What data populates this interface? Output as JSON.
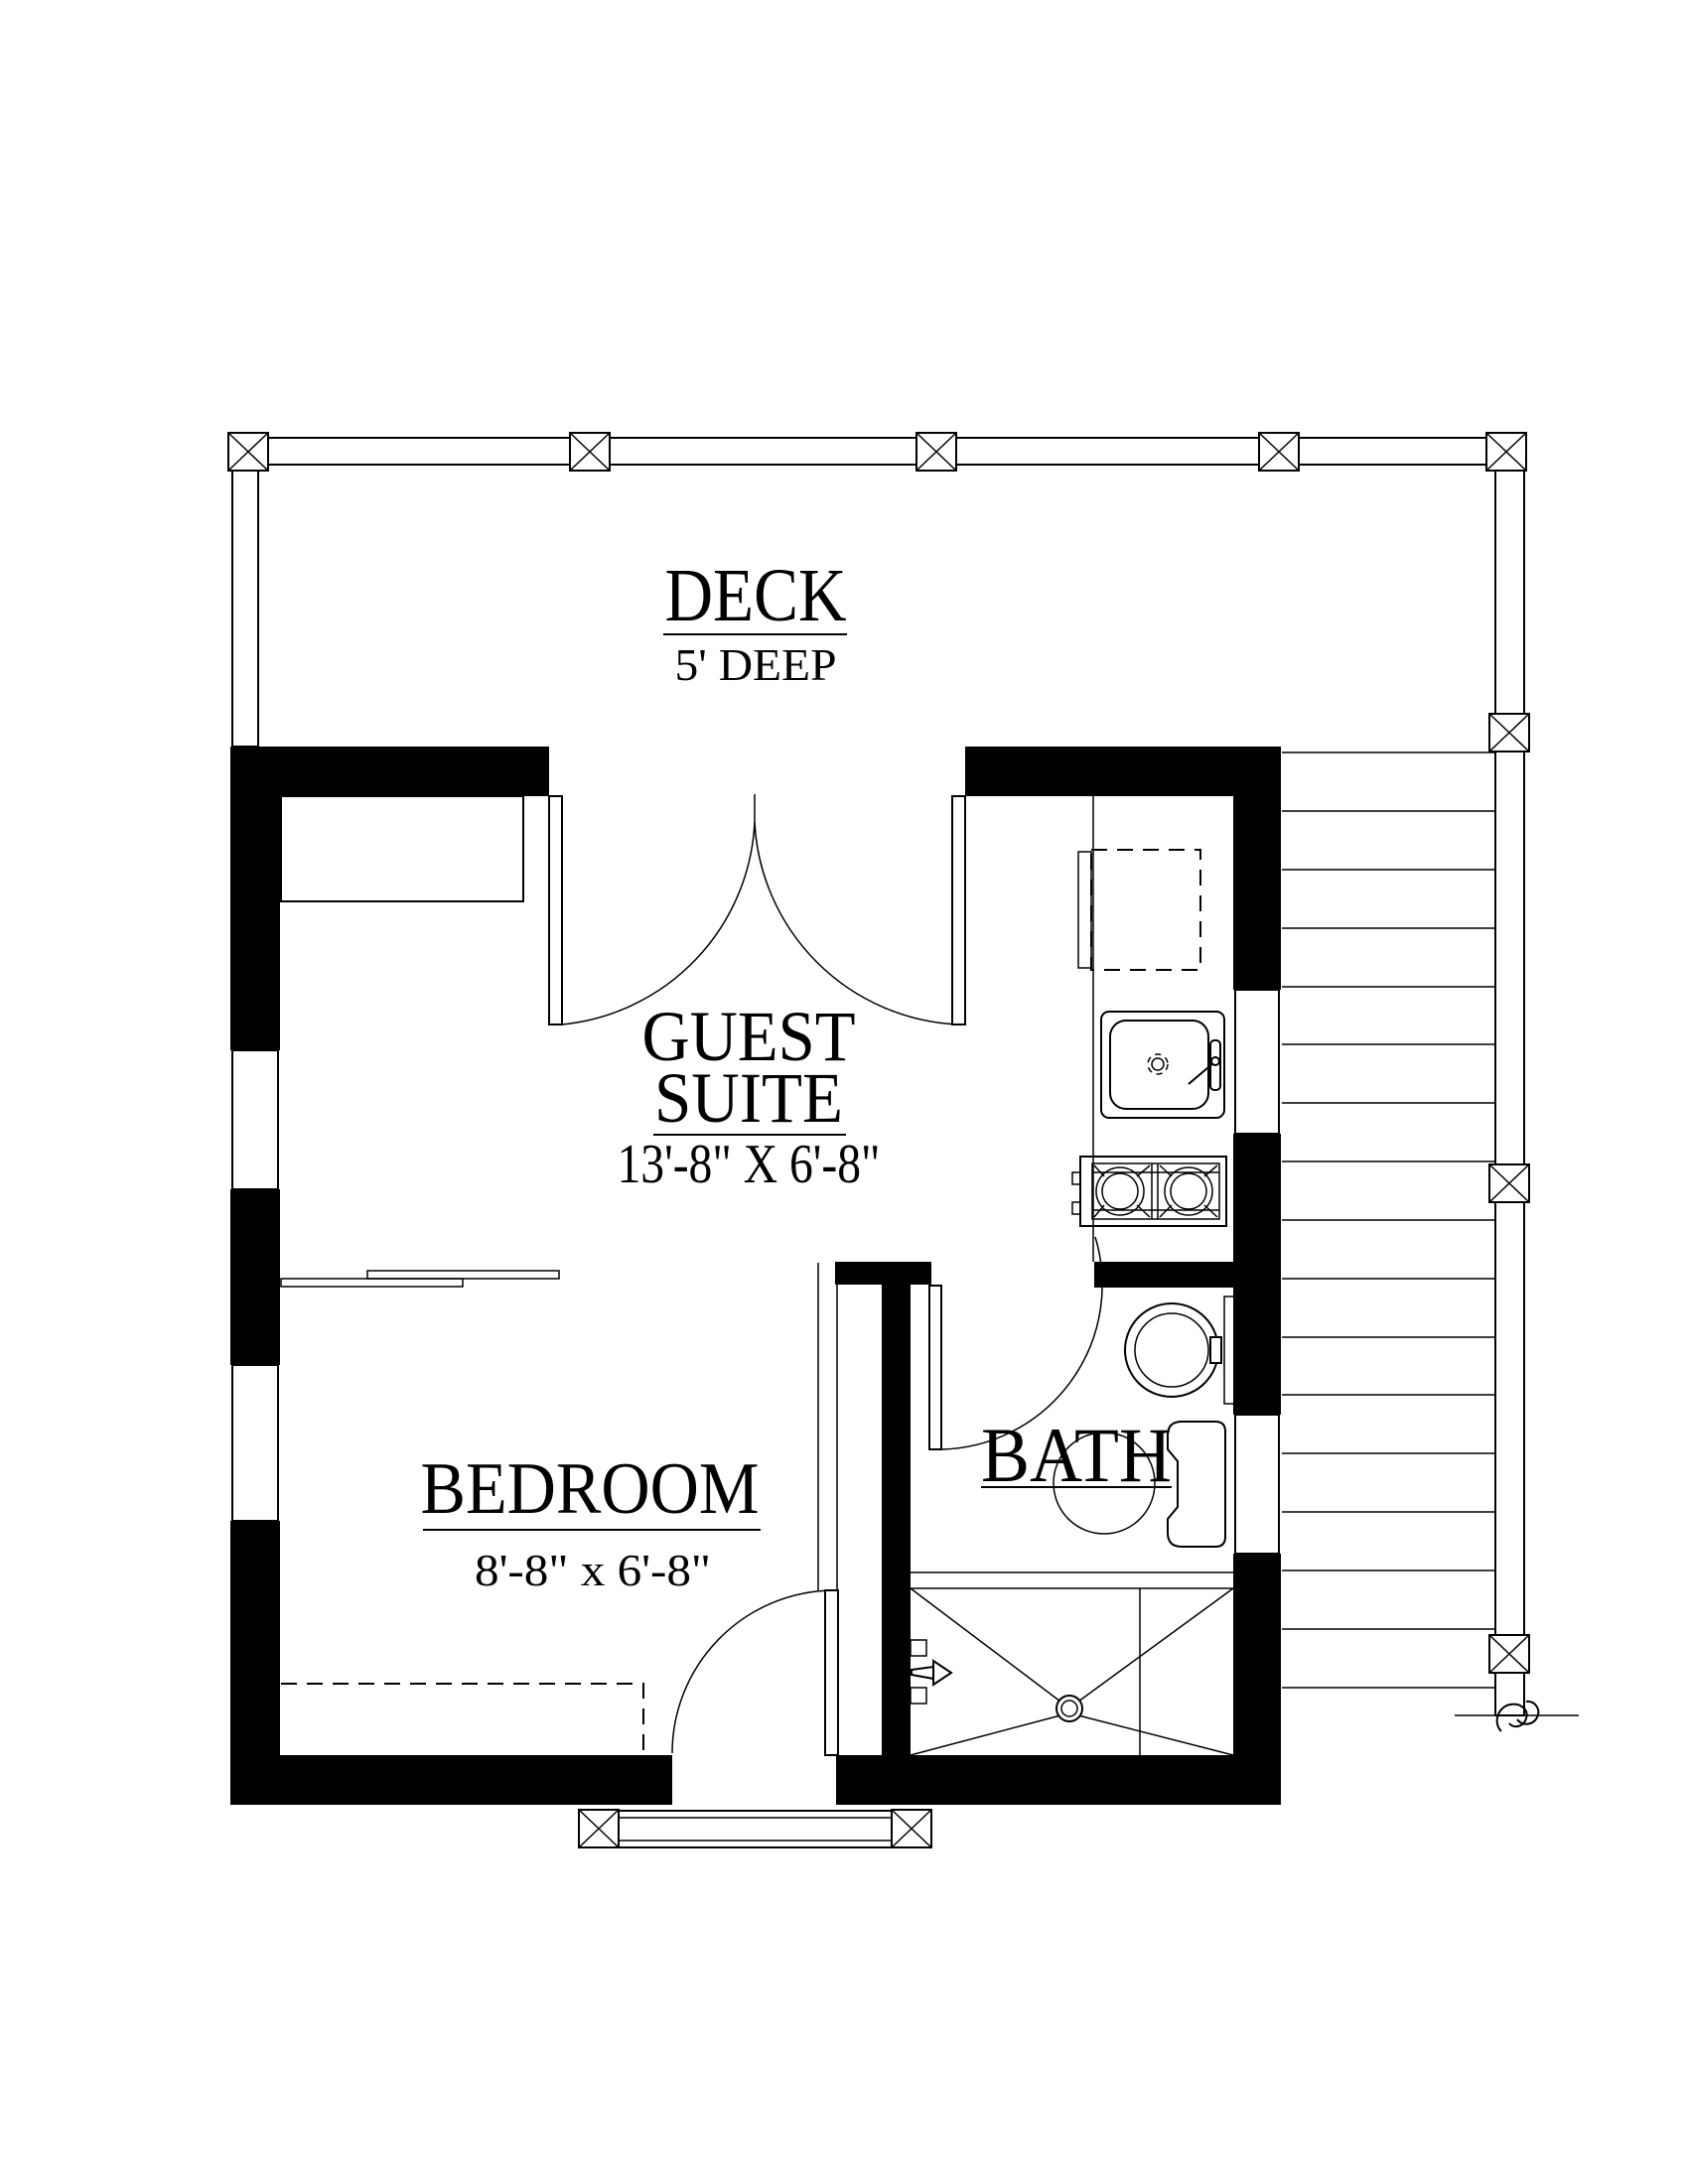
{
  "labels": {
    "deck": {
      "name": "DECK",
      "dimension": "5' DEEP"
    },
    "guest_suite": {
      "line1": "GUEST",
      "line2": "SUITE",
      "dimension": "13'-8\" X 6'-8\""
    },
    "bedroom": {
      "name": "BEDROOM",
      "dimension": "8'-8\" x 6'-8\""
    },
    "bath": {
      "name": "BATH"
    }
  },
  "colors": {
    "wall": "#000000",
    "line": "#000000",
    "background": "#ffffff"
  }
}
